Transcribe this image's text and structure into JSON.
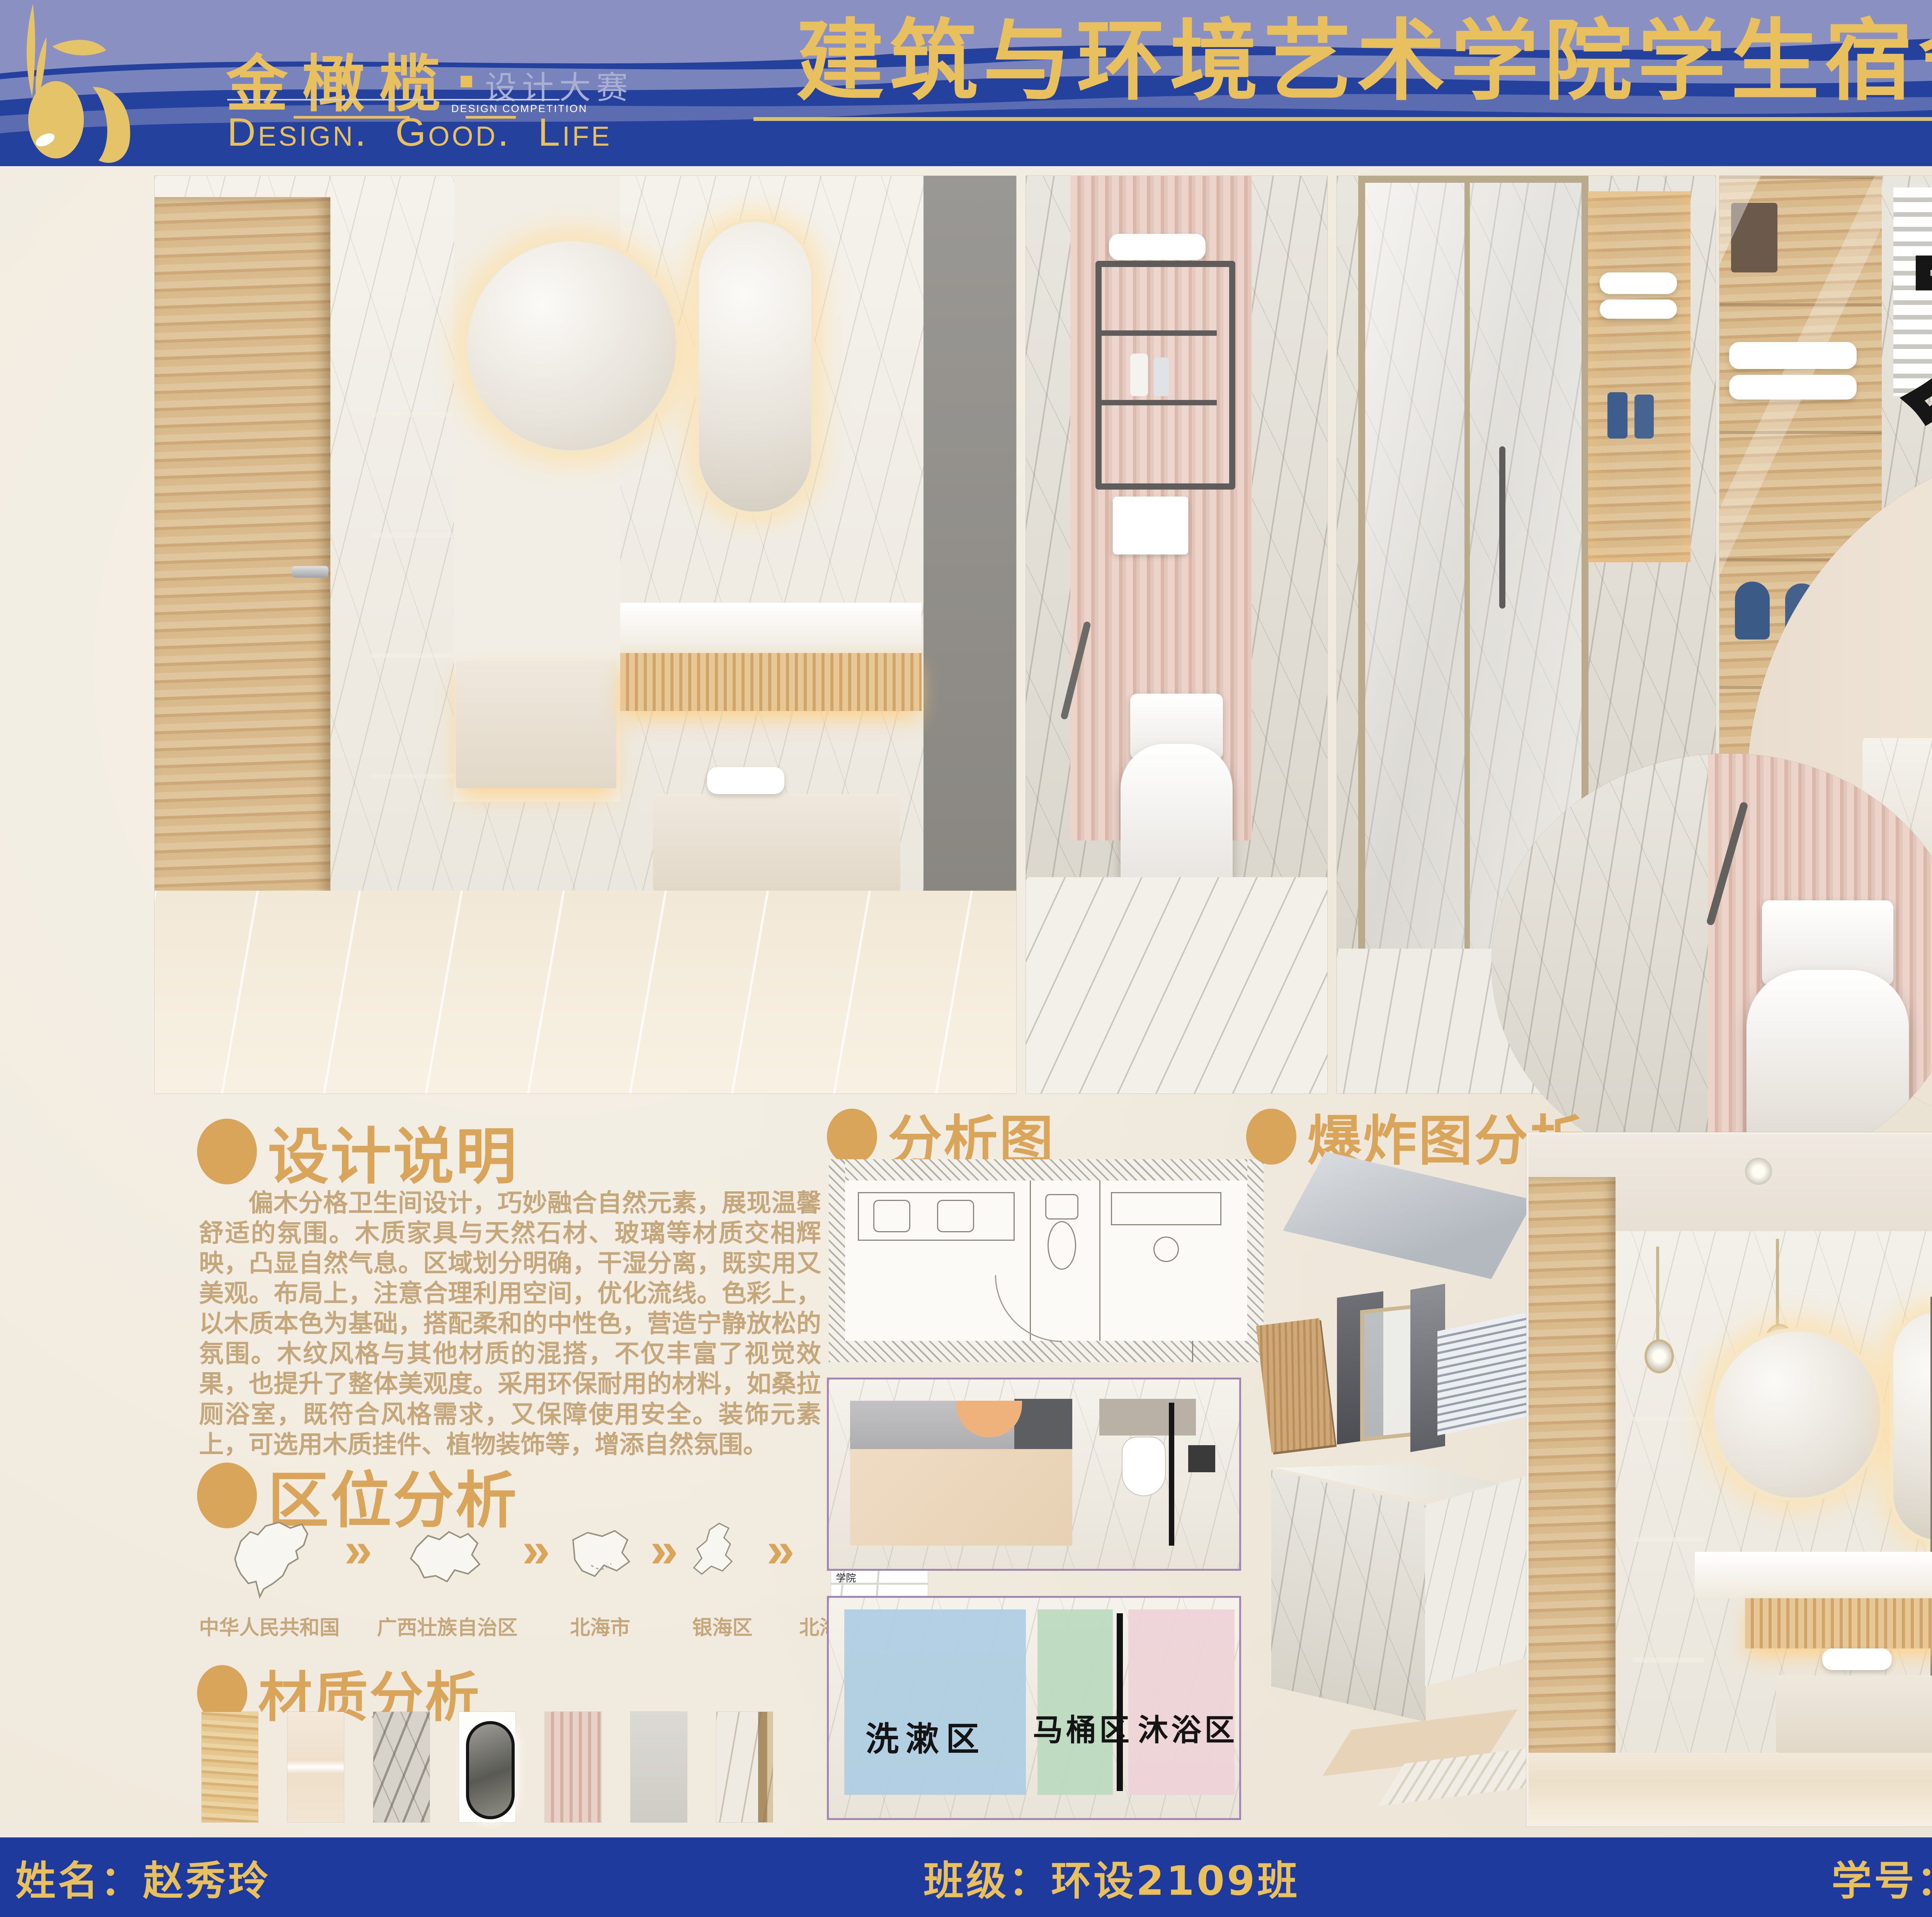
{
  "colors": {
    "blue": "#24419E",
    "blue2": "#1E3A9C",
    "peri": "#8A90C1",
    "gold": "#E9C05E",
    "accent": "#D9A55B",
    "tan": "#C4A87B",
    "cream": "#F0E9DC",
    "zone_blue": "#AECDE3",
    "zone_green": "#BBDABF",
    "zone_pink": "#EED2D7"
  },
  "header": {
    "logo": {
      "name": "金橄榄",
      "subtitle": "设计大赛",
      "subtitle_en": "DESIGN COMPETITION",
      "slogan": [
        "Design.",
        "Good.",
        "Life"
      ]
    },
    "title": "建筑与环境艺术学院学生宿舍卫生间设计大赛"
  },
  "art_title": [
    "木",
    "澜",
    "清",
    "悦"
  ],
  "sections": {
    "design_note": {
      "heading": "设计说明",
      "body": "偏木分格卫生间设计，巧妙融合自然元素，展现温馨舒适的氛围。木质家具与天然石材、玻璃等材质交相辉映，凸显自然气息。区域划分明确，干湿分离，既实用又美观。布局上，注意合理利用空间，优化流线。色彩上，以木质本色为基础，搭配柔和的中性色，营造宁静放松的氛围。木纹风格与其他材质的混搭，不仅丰富了视觉效果，也提升了整体美观度。采用环保耐用的材料，如桑拉厕浴室，既符合风格需求，又保障使用安全。装饰元素上，可选用木质挂件、植物装饰等，增添自然氛围。"
    },
    "location": {
      "heading": "区位分析",
      "chevron": "»",
      "steps": [
        {
          "label": "中华人民共和国"
        },
        {
          "label": "广西壮族自治区"
        },
        {
          "label": "北海市"
        },
        {
          "label": "银海区"
        },
        {
          "label": "北海艺术设计学院"
        }
      ],
      "street_map": {
        "road": "新世纪大道",
        "poi": "沙县小吃(世纪大道)",
        "pin_label": "北海艺术设计学院"
      }
    },
    "material": {
      "heading": "材质分析",
      "swatches": [
        "wood-grain",
        "beige-stone",
        "grey-marble",
        "led-mirror",
        "pink-flute-panel",
        "grey-matte-tile",
        "white-marble-gold-trim"
      ]
    },
    "analysis": {
      "heading": "分析图",
      "zones": [
        "洗漱区",
        "马桶区",
        "沐浴区"
      ]
    },
    "explosion": {
      "heading": "爆炸图分析"
    },
    "gallery": {
      "heading": "效果图展示"
    }
  },
  "footer": {
    "name": "姓名：赵秀玲",
    "class": "班级：环设2109班",
    "student_id": "学号：202140866"
  }
}
